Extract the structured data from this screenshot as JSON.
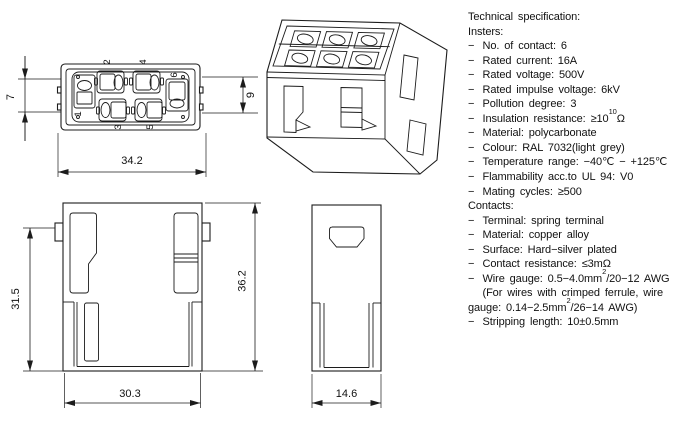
{
  "spec": {
    "lines": [
      {
        "t1": "Technical specification:"
      },
      {
        "t1": "Insters:"
      },
      {
        "b": "−",
        "t1": "No. of contact: 6"
      },
      {
        "b": "−",
        "t1": "Rated current: 16A"
      },
      {
        "b": "−",
        "t1": "Rated voltage: 500V"
      },
      {
        "b": "−",
        "t1": "Rated impulse voltage: 6kV"
      },
      {
        "b": "−",
        "t1": "Pollution degree: 3"
      },
      {
        "b": "−",
        "t1": "Insulation resistance: ≥10",
        "sup": "10",
        "t2": "Ω"
      },
      {
        "b": "−",
        "t1": "Material: polycarbonate"
      },
      {
        "b": "−",
        "t1": "Colour: RAL 7032(light grey)"
      },
      {
        "b": "−",
        "t1": "Temperature range: −40℃ − +125℃"
      },
      {
        "b": "−",
        "t1": "Flammability acc.to UL 94: V0"
      },
      {
        "b": "−",
        "t1": "Mating cycles: ≥500"
      },
      {
        "t1": "Contacts:"
      },
      {
        "b": "−",
        "t1": "Terminal: spring terminal"
      },
      {
        "b": "−",
        "t1": "Material: copper alloy"
      },
      {
        "b": "−",
        "t1": "Surface: Hard−silver plated"
      },
      {
        "b": "−",
        "t1": "Contact resistance: ≤3mΩ"
      },
      {
        "b": "−",
        "t1": "Wire gauge: 0.5−4.0mm",
        "sup": "2",
        "t2": "/20−12 AWG"
      },
      {
        "b": "",
        "t1": "(For wires with crimped ferrule, wire"
      },
      {
        "t1": "gauge: 0.14−2.5mm",
        "sup": "2",
        "t2": "/26−14 AWG)"
      },
      {
        "b": "−",
        "t1": "Stripping length: 10±0.5mm"
      }
    ]
  },
  "dims": {
    "top_width": "34.2",
    "top_depth": "7",
    "right_depth": "9",
    "front_height_inner": "31.5",
    "front_height_total": "36.2",
    "front_width": "30.3",
    "side_width": "14.6"
  },
  "contacts": {
    "numbers": [
      "1",
      "2",
      "3",
      "4",
      "5",
      "6"
    ]
  },
  "colors": {
    "line": "#1c1c1c",
    "text": "#111111",
    "background": "#ffffff"
  }
}
